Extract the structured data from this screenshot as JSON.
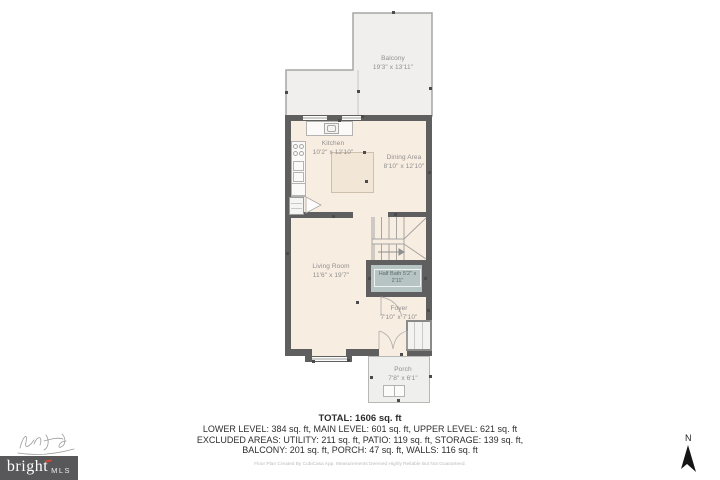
{
  "rooms": {
    "balcony": {
      "name": "Balcony",
      "dims": "19'3\" x 13'11\""
    },
    "kitchen": {
      "name": "Kitchen",
      "dims": "10'2\" x 12'10\""
    },
    "dining": {
      "name": "Dining Area",
      "dims": "8'10\" x 12'10\""
    },
    "living": {
      "name": "Living Room",
      "dims": "11'6\" x 19'7\""
    },
    "half_bath": {
      "name": "Half Bath",
      "dims": "5'2\" x 2'11\""
    },
    "foyer": {
      "name": "Foyer",
      "dims": "7'10\" x 7'10\""
    },
    "porch": {
      "name": "Porch",
      "dims": "7'8\" x 6'1\""
    }
  },
  "summary": {
    "total_label": "TOTAL: 1606 sq. ft",
    "levels_line": "LOWER LEVEL: 384 sq. ft, MAIN LEVEL: 601 sq. ft, UPPER LEVEL: 621 sq. ft",
    "excluded_line1": "EXCLUDED AREAS: UTILITY: 211 sq. ft, PATIO: 119 sq. ft, STORAGE: 139 sq. ft,",
    "excluded_line2": "BALCONY: 201 sq. ft, PORCH: 47 sq. ft, WALLS: 116 sq. ft",
    "disclaimer": "Floor Plan Created By CubiCasa App. Measurements Deemed Highly Reliable But Not Guaranteed."
  },
  "branding": {
    "logo_text": "bright",
    "logo_suffix": "MLS"
  },
  "compass": {
    "north_label": "N"
  },
  "colors": {
    "wall": "#5f5f5f",
    "floor": "#f8ede1",
    "balcony_floor": "#f0efed",
    "half_bath_floor": "#b6c5c4",
    "logo_background": "#58585a",
    "logo_accent": "#cf4b32"
  }
}
